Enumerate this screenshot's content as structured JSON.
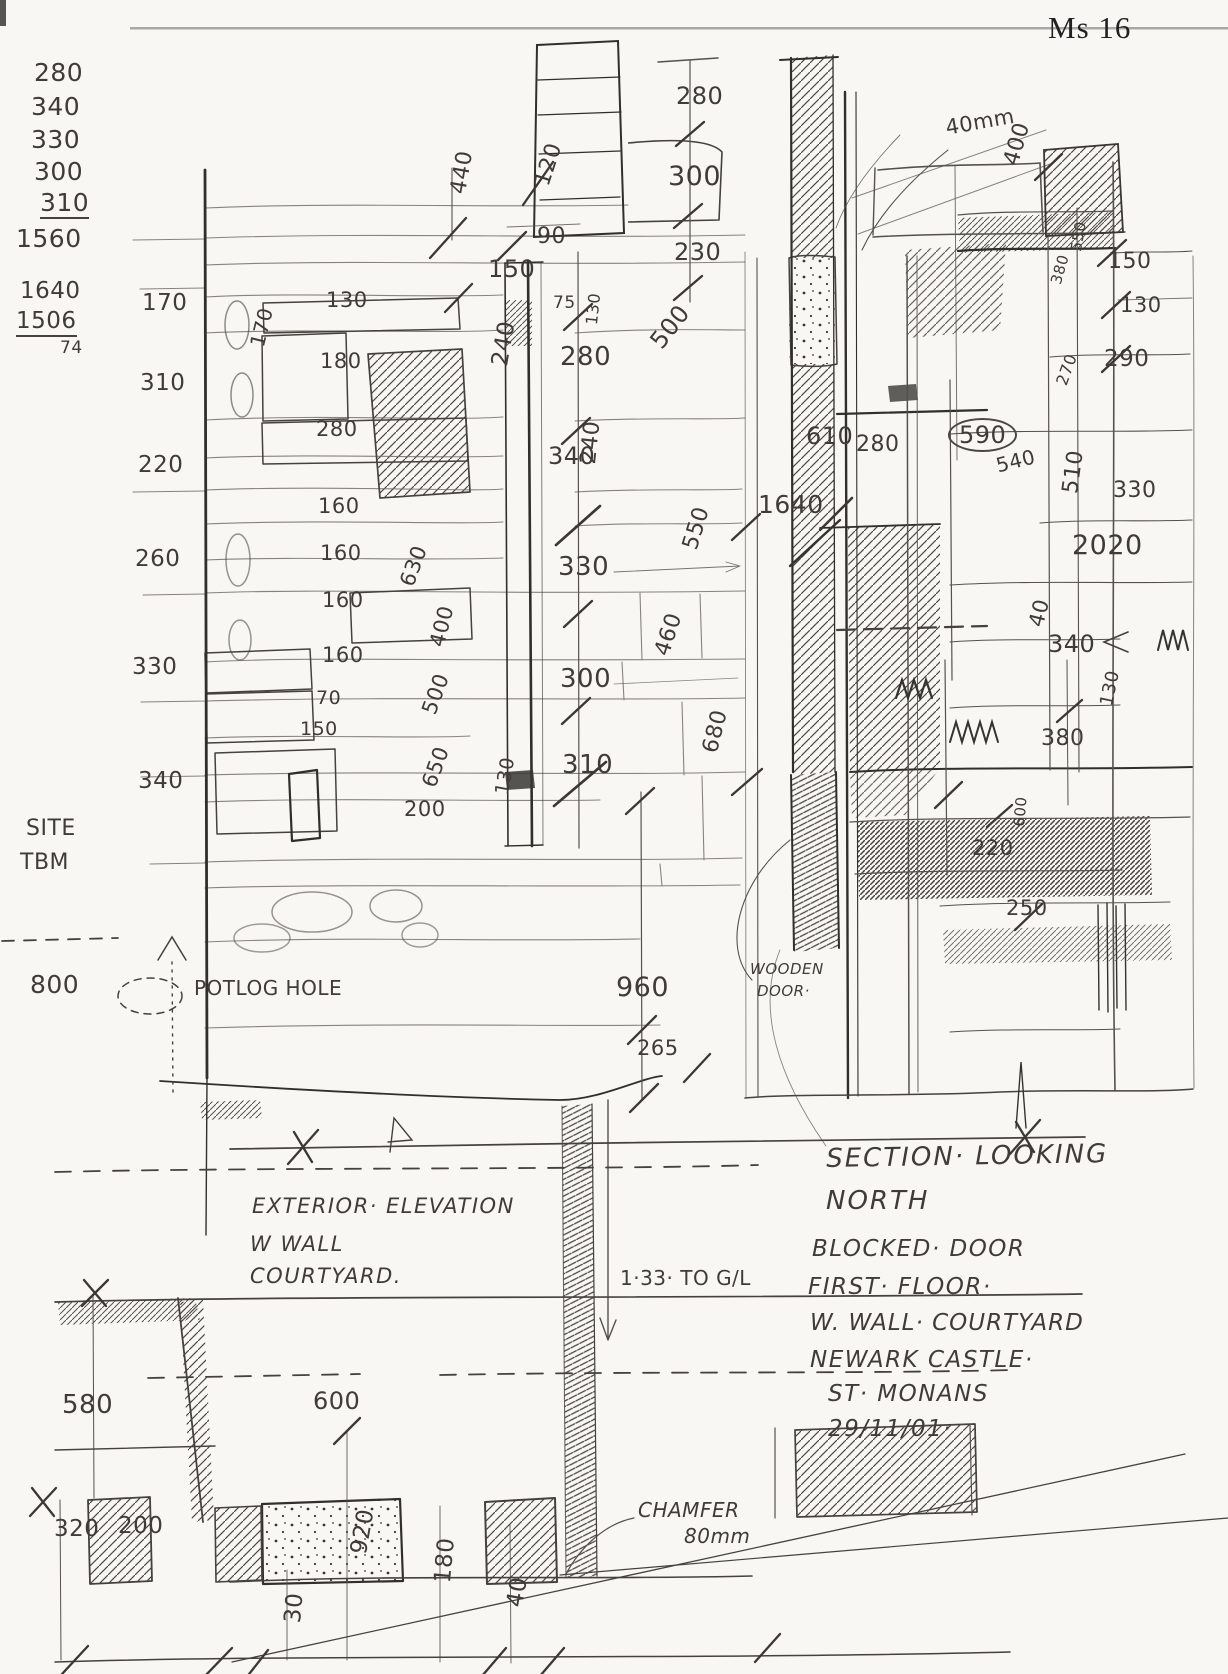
{
  "sheet": {
    "number": "Ms 16"
  },
  "colors": {
    "pencil": "#3f3c38",
    "paper": "#f8f7f3"
  },
  "calc_column": {
    "values": [
      "280",
      "340",
      "330",
      "300",
      "310"
    ],
    "sum": "1560",
    "second_values": [
      "1640",
      "1506"
    ],
    "second_result": "74"
  },
  "titles": {
    "section_note": [
      "SECTION· LOOKING",
      "NORTH"
    ],
    "subject_note": [
      "BLOCKED· DOOR",
      "FIRST· FLOOR·",
      "W. WALL· COURTYARD",
      "NEWARK CASTLE·",
      "ST· MONANS",
      "29/11/01·"
    ],
    "elevation_note": [
      "EXTERIOR· ELEVATION",
      "W WALL",
      "COURTYARD."
    ]
  },
  "annotations": [
    {
      "name": "calc-value",
      "group": "calc-column",
      "text": "280",
      "x": 34,
      "y": 60,
      "size": 25
    },
    {
      "name": "calc-value",
      "group": "calc-column",
      "text": "340",
      "x": 31,
      "y": 94,
      "size": 25
    },
    {
      "name": "calc-value",
      "group": "calc-column",
      "text": "330",
      "x": 31,
      "y": 127,
      "size": 25
    },
    {
      "name": "calc-value",
      "group": "calc-column",
      "text": "300",
      "x": 34,
      "y": 159,
      "size": 25
    },
    {
      "name": "calc-value",
      "group": "calc-column",
      "text": "310",
      "x": 40,
      "y": 190,
      "size": 25,
      "underline": true
    },
    {
      "name": "calc-sum",
      "group": "calc-column",
      "text": "1560",
      "x": 16,
      "y": 226,
      "size": 25
    },
    {
      "name": "calc-value",
      "group": "calc-column",
      "text": "1640",
      "x": 20,
      "y": 280,
      "size": 23
    },
    {
      "name": "calc-value",
      "group": "calc-column",
      "text": "1506",
      "x": 16,
      "y": 310,
      "size": 23,
      "underline": true
    },
    {
      "name": "calc-result",
      "group": "calc-column",
      "text": "74",
      "x": 60,
      "y": 340,
      "size": 17
    },
    {
      "name": "dim-label",
      "group": "elevation-top",
      "text": "440",
      "x": 448,
      "y": 192,
      "size": 22,
      "rot": -80
    },
    {
      "name": "dim-label",
      "group": "elevation-top",
      "text": "120",
      "x": 532,
      "y": 182,
      "size": 22,
      "rot": -72
    },
    {
      "name": "dim-label",
      "group": "elevation-top",
      "text": "280",
      "x": 676,
      "y": 84,
      "size": 24
    },
    {
      "name": "dim-label",
      "group": "elevation-top",
      "text": "300",
      "x": 668,
      "y": 163,
      "size": 27
    },
    {
      "name": "dim-label",
      "group": "elevation-top",
      "text": "230",
      "x": 674,
      "y": 240,
      "size": 24
    },
    {
      "name": "dim-label",
      "group": "elevation-top",
      "text": "90",
      "x": 537,
      "y": 226,
      "size": 22
    },
    {
      "name": "dim-label",
      "group": "elevation-top",
      "text": "150",
      "x": 488,
      "y": 257,
      "size": 24
    },
    {
      "name": "dim-label",
      "group": "elevation-top",
      "text": "75",
      "x": 553,
      "y": 295,
      "size": 17
    },
    {
      "name": "dim-label",
      "group": "elevation-center",
      "text": "130",
      "x": 584,
      "y": 324,
      "size": 16,
      "rot": -84
    },
    {
      "name": "dim-label",
      "group": "elevation-center",
      "text": "280",
      "x": 560,
      "y": 344,
      "size": 26
    },
    {
      "name": "dim-label",
      "group": "elevation-center",
      "text": "500",
      "x": 646,
      "y": 338,
      "size": 24,
      "rot": -52
    },
    {
      "name": "dim-label",
      "group": "elevation-center",
      "text": "240",
      "x": 489,
      "y": 364,
      "size": 23,
      "rot": -80
    },
    {
      "name": "dim-label",
      "group": "elevation-center",
      "text": "340",
      "x": 548,
      "y": 444,
      "size": 24
    },
    {
      "name": "dim-label",
      "group": "elevation-center",
      "text": "240",
      "x": 578,
      "y": 463,
      "size": 22,
      "rot": -84
    },
    {
      "name": "dim-label",
      "group": "elevation-center",
      "text": "330",
      "x": 558,
      "y": 554,
      "size": 26
    },
    {
      "name": "dim-label",
      "group": "elevation-center",
      "text": "550",
      "x": 680,
      "y": 546,
      "size": 22,
      "rot": -73
    },
    {
      "name": "dim-label",
      "group": "elevation-center",
      "text": "300",
      "x": 560,
      "y": 666,
      "size": 26
    },
    {
      "name": "dim-label",
      "group": "elevation-center",
      "text": "460",
      "x": 652,
      "y": 652,
      "size": 22,
      "rot": -72
    },
    {
      "name": "dim-label",
      "group": "elevation-center",
      "text": "310",
      "x": 562,
      "y": 752,
      "size": 26
    },
    {
      "name": "dim-label",
      "group": "elevation-center",
      "text": "680",
      "x": 700,
      "y": 750,
      "size": 22,
      "rot": -76
    },
    {
      "name": "course-height",
      "group": "left-column",
      "text": "170",
      "x": 142,
      "y": 292,
      "size": 23
    },
    {
      "name": "course-height",
      "group": "left-column",
      "text": "310",
      "x": 140,
      "y": 372,
      "size": 23
    },
    {
      "name": "course-height",
      "group": "left-column",
      "text": "220",
      "x": 138,
      "y": 454,
      "size": 23
    },
    {
      "name": "course-height",
      "group": "left-column",
      "text": "260",
      "x": 135,
      "y": 548,
      "size": 23
    },
    {
      "name": "course-height",
      "group": "left-column",
      "text": "330",
      "x": 132,
      "y": 656,
      "size": 23
    },
    {
      "name": "course-height",
      "group": "left-column",
      "text": "340",
      "x": 138,
      "y": 770,
      "size": 23
    },
    {
      "name": "dim-label",
      "group": "elevation-stones",
      "text": "130",
      "x": 326,
      "y": 290,
      "size": 21
    },
    {
      "name": "dim-label",
      "group": "elevation-stones",
      "text": "170",
      "x": 247,
      "y": 344,
      "size": 20,
      "rot": -76
    },
    {
      "name": "dim-label",
      "group": "elevation-stones",
      "text": "180",
      "x": 320,
      "y": 351,
      "size": 21
    },
    {
      "name": "dim-label",
      "group": "elevation-stones",
      "text": "280",
      "x": 316,
      "y": 419,
      "size": 21
    },
    {
      "name": "dim-label",
      "group": "elevation-stones",
      "text": "160",
      "x": 318,
      "y": 496,
      "size": 21
    },
    {
      "name": "dim-label",
      "group": "elevation-stones",
      "text": "160",
      "x": 320,
      "y": 543,
      "size": 21
    },
    {
      "name": "dim-label",
      "group": "elevation-stones",
      "text": "160",
      "x": 322,
      "y": 590,
      "size": 21
    },
    {
      "name": "dim-label",
      "group": "elevation-stones",
      "text": "630",
      "x": 397,
      "y": 582,
      "size": 21,
      "rot": -70
    },
    {
      "name": "dim-label",
      "group": "elevation-stones",
      "text": "160",
      "x": 322,
      "y": 645,
      "size": 21
    },
    {
      "name": "dim-label",
      "group": "elevation-stones",
      "text": "400",
      "x": 427,
      "y": 644,
      "size": 21,
      "rot": -76
    },
    {
      "name": "dim-label",
      "group": "elevation-stones",
      "text": "70",
      "x": 316,
      "y": 689,
      "size": 19
    },
    {
      "name": "dim-label",
      "group": "elevation-stones",
      "text": "150",
      "x": 300,
      "y": 720,
      "size": 19
    },
    {
      "name": "dim-label",
      "group": "elevation-stones",
      "text": "500",
      "x": 419,
      "y": 710,
      "size": 21,
      "rot": -70
    },
    {
      "name": "dim-label",
      "group": "elevation-stones",
      "text": "650",
      "x": 419,
      "y": 783,
      "size": 21,
      "rot": -70
    },
    {
      "name": "dim-label",
      "group": "elevation-stones",
      "text": "200",
      "x": 404,
      "y": 799,
      "size": 21
    },
    {
      "name": "dim-label",
      "group": "elevation-stones",
      "text": "130",
      "x": 493,
      "y": 793,
      "size": 19,
      "rot": -80
    },
    {
      "name": "dim-label",
      "group": "elevation-bottom",
      "text": "960",
      "x": 616,
      "y": 974,
      "size": 27
    },
    {
      "name": "dim-label",
      "group": "elevation-bottom",
      "text": "265",
      "x": 637,
      "y": 1038,
      "size": 21
    },
    {
      "name": "note-label",
      "group": "elevation-bottom",
      "text": "WOODEN",
      "x": 750,
      "y": 962,
      "size": 15,
      "italic": true
    },
    {
      "name": "note-label",
      "group": "elevation-bottom",
      "text": "DOOR·",
      "x": 757,
      "y": 984,
      "size": 15,
      "italic": true
    },
    {
      "name": "note-label",
      "group": "elevation-bottom",
      "text": "POTLOG HOLE",
      "x": 194,
      "y": 978,
      "size": 20
    },
    {
      "name": "benchmark-label",
      "group": "left-margin",
      "text": "SITE",
      "x": 26,
      "y": 818,
      "size": 22
    },
    {
      "name": "benchmark-label",
      "group": "left-margin",
      "text": "TBM",
      "x": 20,
      "y": 852,
      "size": 22
    },
    {
      "name": "dim-label",
      "group": "left-margin",
      "text": "800",
      "x": 30,
      "y": 972,
      "size": 25
    },
    {
      "name": "dim-label",
      "group": "section",
      "text": "40mm",
      "x": 944,
      "y": 118,
      "size": 21,
      "rot": -10
    },
    {
      "name": "dim-label",
      "group": "section",
      "text": "400",
      "x": 1001,
      "y": 162,
      "size": 22,
      "rot": -74
    },
    {
      "name": "dim-label",
      "group": "section",
      "text": "550",
      "x": 1069,
      "y": 250,
      "size": 15,
      "rot": -80
    },
    {
      "name": "dim-label",
      "group": "section",
      "text": "380",
      "x": 1049,
      "y": 282,
      "size": 15,
      "rot": -74
    },
    {
      "name": "dim-label",
      "group": "section",
      "text": "150",
      "x": 1108,
      "y": 251,
      "size": 22
    },
    {
      "name": "dim-label",
      "group": "section",
      "text": "130",
      "x": 1120,
      "y": 295,
      "size": 21
    },
    {
      "name": "dim-label",
      "group": "section",
      "text": "290",
      "x": 1104,
      "y": 348,
      "size": 23
    },
    {
      "name": "dim-label",
      "group": "section",
      "text": "270",
      "x": 1054,
      "y": 382,
      "size": 16,
      "rot": -70
    },
    {
      "name": "dim-label",
      "group": "section",
      "text": "610",
      "x": 806,
      "y": 424,
      "size": 24
    },
    {
      "name": "dim-label",
      "group": "section",
      "text": "280",
      "x": 856,
      "y": 434,
      "size": 22
    },
    {
      "name": "dim-label",
      "group": "section",
      "text": "590",
      "x": 948,
      "y": 418,
      "size": 24,
      "circle": true
    },
    {
      "name": "dim-label",
      "group": "section",
      "text": "540",
      "x": 994,
      "y": 456,
      "size": 20,
      "rot": -14
    },
    {
      "name": "dim-label",
      "group": "section",
      "text": "1640",
      "x": 758,
      "y": 492,
      "size": 25
    },
    {
      "name": "dim-label",
      "group": "section",
      "text": "510",
      "x": 1060,
      "y": 492,
      "size": 22,
      "rot": -82
    },
    {
      "name": "dim-label",
      "group": "section",
      "text": "330",
      "x": 1113,
      "y": 480,
      "size": 22
    },
    {
      "name": "dim-label",
      "group": "section",
      "text": "2020",
      "x": 1072,
      "y": 532,
      "size": 27
    },
    {
      "name": "dim-label",
      "group": "section",
      "text": "40",
      "x": 1026,
      "y": 624,
      "size": 21,
      "rot": -76
    },
    {
      "name": "dim-label",
      "group": "section",
      "text": "340",
      "x": 1048,
      "y": 632,
      "size": 24
    },
    {
      "name": "dim-label",
      "group": "section",
      "text": "380",
      "x": 1041,
      "y": 728,
      "size": 22
    },
    {
      "name": "dim-label",
      "group": "section",
      "text": "130",
      "x": 1098,
      "y": 704,
      "size": 18,
      "rot": -78
    },
    {
      "name": "dim-label",
      "group": "section",
      "text": "220",
      "x": 972,
      "y": 838,
      "size": 21
    },
    {
      "name": "dim-label",
      "group": "section",
      "text": "600",
      "x": 1012,
      "y": 826,
      "size": 15,
      "rot": -85
    },
    {
      "name": "dim-label",
      "group": "section",
      "text": "250",
      "x": 1006,
      "y": 898,
      "size": 21
    },
    {
      "name": "note-line",
      "group": "section-title",
      "text": "SECTION· LOOKING",
      "x": 826,
      "y": 1146,
      "size": 26,
      "italic": true,
      "rot": -1,
      "ls": 2
    },
    {
      "name": "note-line",
      "group": "section-title",
      "text": "NORTH",
      "x": 826,
      "y": 1188,
      "size": 26,
      "italic": true,
      "ls": 2
    },
    {
      "name": "note-line",
      "group": "subject-note",
      "text": "BLOCKED· DOOR",
      "x": 812,
      "y": 1238,
      "size": 23,
      "italic": true,
      "ls": 1.5
    },
    {
      "name": "note-line",
      "group": "subject-note",
      "text": "FIRST· FLOOR·",
      "x": 808,
      "y": 1276,
      "size": 23,
      "italic": true,
      "ls": 1.5
    },
    {
      "name": "note-line",
      "group": "subject-note",
      "text": "W. WALL· COURTYARD",
      "x": 810,
      "y": 1312,
      "size": 23,
      "italic": true,
      "ls": 1
    },
    {
      "name": "note-line",
      "group": "subject-note",
      "text": "NEWARK CASTLE·",
      "x": 810,
      "y": 1349,
      "size": 23,
      "italic": true,
      "ls": 1.5
    },
    {
      "name": "note-line",
      "group": "subject-note",
      "text": "ST· MONANS",
      "x": 828,
      "y": 1383,
      "size": 23,
      "italic": true,
      "ls": 1.5
    },
    {
      "name": "note-line",
      "group": "subject-note",
      "text": "29/11/01·",
      "x": 828,
      "y": 1418,
      "size": 23,
      "italic": true,
      "ls": 1.5
    },
    {
      "name": "note-line",
      "group": "elevation-title",
      "text": "EXTERIOR· ELEVATION",
      "x": 252,
      "y": 1196,
      "size": 21,
      "italic": true,
      "ls": 1.5
    },
    {
      "name": "note-line",
      "group": "elevation-title",
      "text": "W WALL",
      "x": 250,
      "y": 1234,
      "size": 21,
      "italic": true,
      "ls": 1.5
    },
    {
      "name": "note-line",
      "group": "elevation-title",
      "text": "COURTYARD.",
      "x": 250,
      "y": 1266,
      "size": 21,
      "italic": true,
      "ls": 1.5
    },
    {
      "name": "dim-label",
      "group": "ground",
      "text": "1·33· TO G/L",
      "x": 620,
      "y": 1268,
      "size": 20
    },
    {
      "name": "dim-label",
      "group": "ground",
      "text": "580",
      "x": 62,
      "y": 1392,
      "size": 26
    },
    {
      "name": "dim-label",
      "group": "ground",
      "text": "600",
      "x": 313,
      "y": 1389,
      "size": 24
    },
    {
      "name": "dim-label",
      "group": "ground",
      "text": "320",
      "x": 54,
      "y": 1518,
      "size": 23
    },
    {
      "name": "dim-label",
      "group": "ground",
      "text": "200",
      "x": 118,
      "y": 1515,
      "size": 23
    },
    {
      "name": "note-label",
      "group": "ground",
      "text": "CHAMFER",
      "x": 638,
      "y": 1500,
      "size": 20,
      "italic": true
    },
    {
      "name": "note-label",
      "group": "ground",
      "text": "80mm",
      "x": 684,
      "y": 1526,
      "size": 20,
      "italic": true
    },
    {
      "name": "dim-label",
      "group": "plinth",
      "text": "920",
      "x": 348,
      "y": 1552,
      "size": 23,
      "rot": -80
    },
    {
      "name": "dim-label",
      "group": "plinth",
      "text": "180",
      "x": 432,
      "y": 1582,
      "size": 23,
      "rot": -85
    },
    {
      "name": "dim-label",
      "group": "plinth",
      "text": "40",
      "x": 504,
      "y": 1605,
      "size": 23,
      "rot": -80
    },
    {
      "name": "dim-label",
      "group": "plinth",
      "text": "30",
      "x": 282,
      "y": 1622,
      "size": 23,
      "rot": -85
    }
  ]
}
